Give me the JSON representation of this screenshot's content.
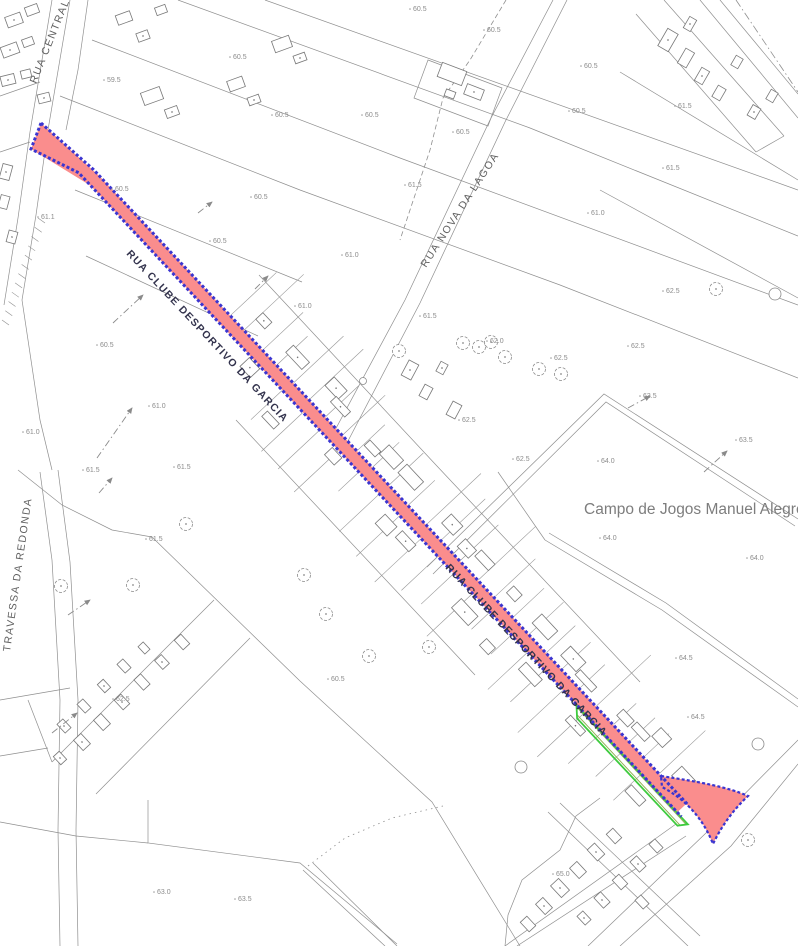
{
  "map": {
    "annotations": {
      "campo": "Campo de Jogos Manuel Alegre"
    },
    "streets": {
      "rua_central": "RUA CENTRAL",
      "rua_nova_da_lagoa": "RUA NOVA DA LAGOA",
      "travessa_da_redonda": "TRAVESSA DA REDONDA",
      "rua_clube_1": "RUA CLUBE DESPORTIVO DA GARCIA",
      "rua_clube_2": "RUA CLUBE DESPORTIVO DA GARCIA"
    },
    "highlight": {
      "road_name": "RUA CLUBE DESPORTIVO DA GARCIA",
      "fill_color": "#fa8d8d",
      "border_color": "#3b35d0",
      "green_strip_color": "#3ecb3e"
    },
    "spot_elevations": [
      {
        "x": 238,
        "y": 56,
        "v": "60.5"
      },
      {
        "x": 112,
        "y": 79,
        "v": "59.5"
      },
      {
        "x": 120,
        "y": 188,
        "v": "60.5"
      },
      {
        "x": 46,
        "y": 216,
        "v": "61.1"
      },
      {
        "x": 259,
        "y": 196,
        "v": "60.5"
      },
      {
        "x": 218,
        "y": 240,
        "v": "60.5"
      },
      {
        "x": 418,
        "y": 8,
        "v": "60.5"
      },
      {
        "x": 492,
        "y": 29,
        "v": "60.5"
      },
      {
        "x": 280,
        "y": 114,
        "v": "60.5"
      },
      {
        "x": 370,
        "y": 114,
        "v": "60.5"
      },
      {
        "x": 461,
        "y": 131,
        "v": "60.5"
      },
      {
        "x": 413,
        "y": 184,
        "v": "61.5"
      },
      {
        "x": 350,
        "y": 254,
        "v": "61.0"
      },
      {
        "x": 589,
        "y": 65,
        "v": "60.5"
      },
      {
        "x": 577,
        "y": 110,
        "v": "60.5"
      },
      {
        "x": 683,
        "y": 105,
        "v": "61.5"
      },
      {
        "x": 671,
        "y": 167,
        "v": "61.5"
      },
      {
        "x": 596,
        "y": 212,
        "v": "61.0"
      },
      {
        "x": 105,
        "y": 344,
        "v": "60.5"
      },
      {
        "x": 157,
        "y": 405,
        "v": "61.0"
      },
      {
        "x": 31,
        "y": 431,
        "v": "61.0"
      },
      {
        "x": 91,
        "y": 469,
        "v": "61.5"
      },
      {
        "x": 182,
        "y": 466,
        "v": "61.5"
      },
      {
        "x": 303,
        "y": 305,
        "v": "61.0"
      },
      {
        "x": 428,
        "y": 315,
        "v": "61.5"
      },
      {
        "x": 495,
        "y": 340,
        "v": "62.0"
      },
      {
        "x": 467,
        "y": 419,
        "v": "62.5"
      },
      {
        "x": 521,
        "y": 458,
        "v": "62.5"
      },
      {
        "x": 671,
        "y": 290,
        "v": "62.5"
      },
      {
        "x": 636,
        "y": 345,
        "v": "62.5"
      },
      {
        "x": 559,
        "y": 357,
        "v": "62.5"
      },
      {
        "x": 648,
        "y": 395,
        "v": "63.5"
      },
      {
        "x": 744,
        "y": 439,
        "v": "63.5"
      },
      {
        "x": 606,
        "y": 460,
        "v": "64.0"
      },
      {
        "x": 154,
        "y": 538,
        "v": "61.5"
      },
      {
        "x": 121,
        "y": 698,
        "v": "62.5"
      },
      {
        "x": 336,
        "y": 678,
        "v": "60.5"
      },
      {
        "x": 608,
        "y": 537,
        "v": "64.0"
      },
      {
        "x": 755,
        "y": 557,
        "v": "64.0"
      },
      {
        "x": 684,
        "y": 657,
        "v": "64.5"
      },
      {
        "x": 696,
        "y": 716,
        "v": "64.5"
      },
      {
        "x": 162,
        "y": 891,
        "v": "63.0"
      },
      {
        "x": 243,
        "y": 898,
        "v": "63.5"
      },
      {
        "x": 561,
        "y": 873,
        "v": "65.0"
      }
    ]
  }
}
